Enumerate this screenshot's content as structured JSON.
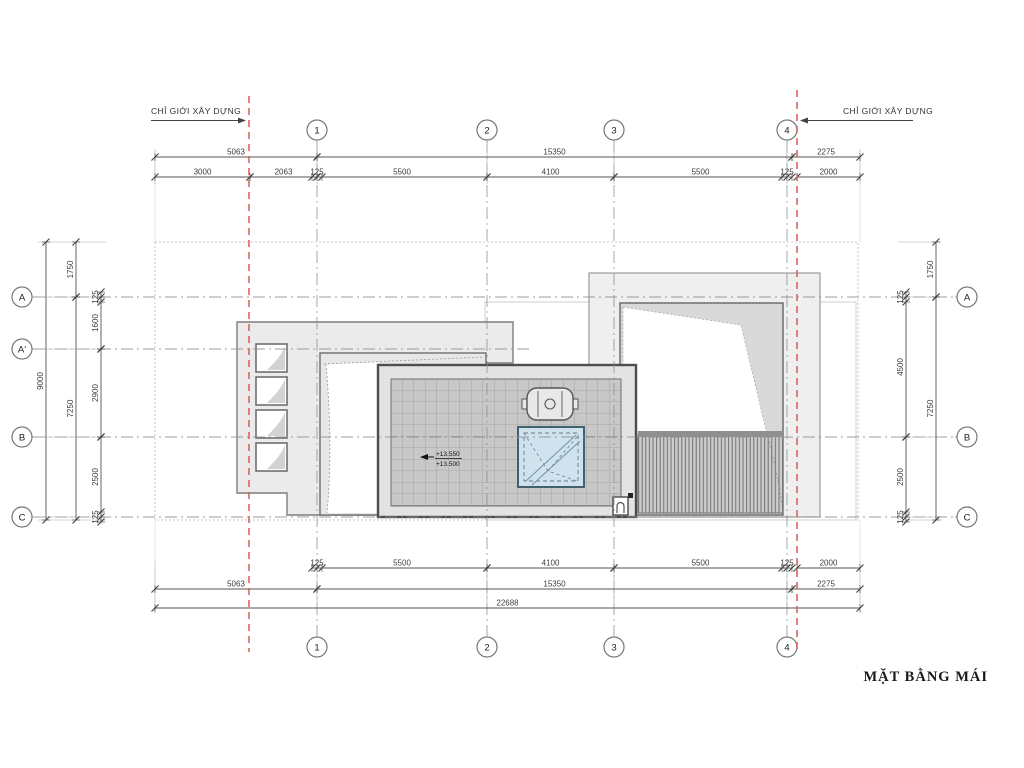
{
  "title": "MẶT BẰNG MÁI",
  "boundary": {
    "left_label": "CHỈ GIỚI XÂY DỰNG",
    "right_label": "CHỈ GIỚI XÂY DỰNG"
  },
  "grid": {
    "columns": [
      "1",
      "2",
      "3",
      "4"
    ],
    "rows_left": [
      "A",
      "A'",
      "B",
      "C"
    ],
    "rows_right": [
      "A",
      "B",
      "C"
    ]
  },
  "levels": {
    "upper": "+13.550",
    "lower": "+13.500"
  },
  "colors": {
    "setback_red": "#e2615e",
    "roof_tile_gray": "#c8c8c8",
    "skylight_blue": "#cfe2ee",
    "block_gray": "#ebebeb",
    "line_dark": "#4d4d4d"
  },
  "dimensions": {
    "top_row1": [
      {
        "v": "5063",
        "a": "siteL",
        "b": "g1"
      },
      {
        "v": "15350",
        "a": "g1",
        "b": "g4b"
      },
      {
        "v": "2275",
        "a": "g4b",
        "b": "right"
      }
    ],
    "top_row2": [
      {
        "v": "3000",
        "a": "siteL",
        "b": "redL"
      },
      {
        "v": "2063",
        "a": "redL",
        "b": "g1"
      },
      {
        "v": "125",
        "a": "g1-",
        "b": "g1+"
      },
      {
        "v": "5500",
        "a": "g1",
        "b": "g2"
      },
      {
        "v": "4100",
        "a": "g2",
        "b": "g3"
      },
      {
        "v": "5500",
        "a": "g3",
        "b": "g4"
      },
      {
        "v": "125",
        "a": "g4-",
        "b": "g4+"
      },
      {
        "v": "2000",
        "a": "redR",
        "b": "right"
      }
    ],
    "bottom_row1": [
      {
        "v": "125",
        "a": "g1-",
        "b": "g1+"
      },
      {
        "v": "5500",
        "a": "g1",
        "b": "g2"
      },
      {
        "v": "4100",
        "a": "g2",
        "b": "g3"
      },
      {
        "v": "5500",
        "a": "g3",
        "b": "g4"
      },
      {
        "v": "125",
        "a": "g4-",
        "b": "g4+"
      },
      {
        "v": "2000",
        "a": "redR",
        "b": "right"
      }
    ],
    "bottom_row2": [
      {
        "v": "5063",
        "a": "siteL",
        "b": "g1"
      },
      {
        "v": "15350",
        "a": "g1",
        "b": "g4b"
      },
      {
        "v": "2275",
        "a": "g4b",
        "b": "right"
      }
    ],
    "bottom_row3": [
      {
        "v": "22688",
        "a": "siteL",
        "b": "right"
      }
    ],
    "left_col1": [
      {
        "v": "9000",
        "a": "siteT",
        "b": "siteB"
      }
    ],
    "left_col2": [
      {
        "v": "1750",
        "a": "siteT",
        "b": "A"
      },
      {
        "v": "7250",
        "a": "A",
        "b": "siteB"
      }
    ],
    "left_col3": [
      {
        "v": "125",
        "a": "A-",
        "b": "A+"
      },
      {
        "v": "1600",
        "a": "A",
        "b": "Aq"
      },
      {
        "v": "2900",
        "a": "Aq",
        "b": "B"
      },
      {
        "v": "2500",
        "a": "B",
        "b": "C"
      },
      {
        "v": "125",
        "a": "C-",
        "b": "C+"
      }
    ],
    "right_col1": [
      {
        "v": "125",
        "a": "A-",
        "b": "A+"
      },
      {
        "v": "4500",
        "a": "A",
        "b": "B"
      },
      {
        "v": "2500",
        "a": "B",
        "b": "C"
      },
      {
        "v": "125",
        "a": "C-",
        "b": "C+"
      }
    ],
    "right_col2": [
      {
        "v": "1750",
        "a": "siteT",
        "b": "A"
      },
      {
        "v": "7250",
        "a": "A",
        "b": "siteB"
      }
    ]
  }
}
